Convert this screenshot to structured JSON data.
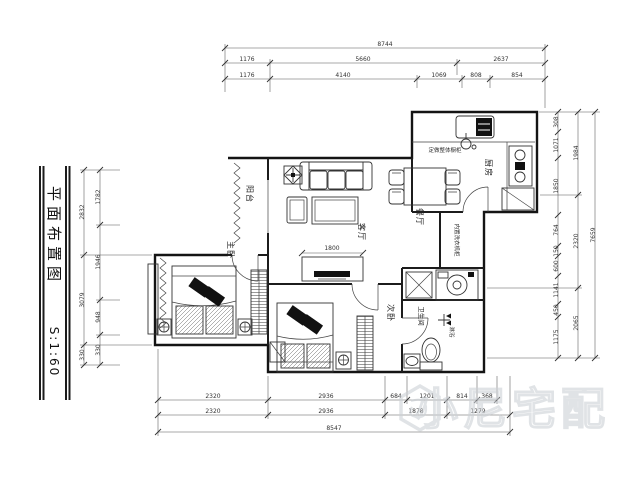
{
  "title_block": {
    "title": "平面布置图",
    "scale": "S:1:60"
  },
  "rooms": {
    "balcony": "阳台",
    "living": "客厅",
    "dining": "餐厅",
    "kitchen": "厨房",
    "master": "主卧",
    "second": "次卧",
    "bath": "卫生间"
  },
  "annotations": {
    "kitchen_cabinet": "定做整体橱柜",
    "washer_cabinet": "内置洗衣机柜",
    "shower": "淋浴",
    "tv_width": "1800"
  },
  "dims": {
    "top": {
      "overall": "8744",
      "row2": [
        "1176",
        "5660",
        "2637"
      ],
      "row3": [
        "1176",
        "4140",
        "1069",
        "808",
        "854"
      ]
    },
    "bottom": {
      "row1": [
        "2320",
        "2936",
        "684",
        "1201",
        "814",
        "368"
      ],
      "row2": [
        "2320",
        "2936",
        "1878",
        "1279"
      ],
      "overall": "8547"
    },
    "left": {
      "outer": [
        "2832",
        "3079",
        "330"
      ],
      "inner": [
        "1782",
        "1946",
        "948",
        "330"
      ]
    },
    "right": {
      "inner": [
        "308",
        "1071",
        "1850",
        "764",
        "150",
        "600",
        "1141",
        "450",
        "1175"
      ],
      "middle": [
        "1984",
        "2320",
        "2065"
      ],
      "overall": "7659"
    }
  },
  "watermark": {
    "text": "小尼宅配"
  }
}
